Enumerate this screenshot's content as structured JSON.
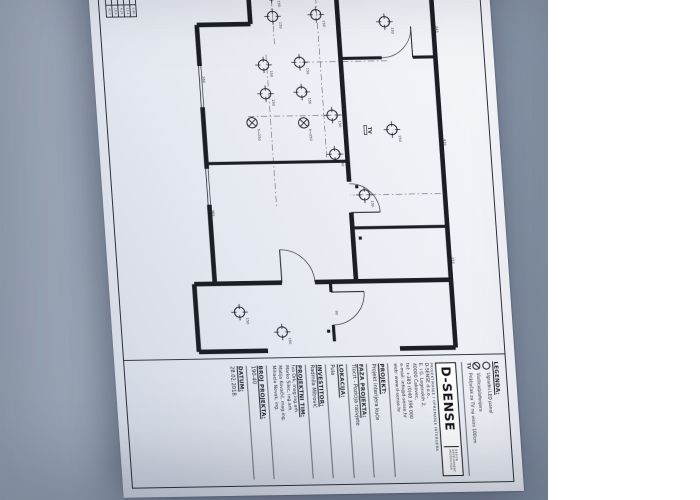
{
  "photo": {
    "backdrop_color": "#97a3b4",
    "paper_color": "#eef0f6"
  },
  "legend": {
    "title": "LEGENDA:",
    "items": [
      {
        "symbol": "led-circle",
        "label": "Ugradni LED panel"
      },
      {
        "symbol": "pendant-circle",
        "label": "Visilica/plafonjera"
      },
      {
        "symbol": "tv",
        "label": "Priključak za TV na visini 100cm"
      }
    ]
  },
  "logo": {
    "name": "D-SENSE",
    "side_words": [
      "DESIGN",
      "DEVELOPMENT",
      "PRODUCTION"
    ],
    "subtitle": "PROJEKTIRANJE I OPREMANJE INTERIJERA"
  },
  "company": {
    "lines": [
      "D-SENSE d.o.o.,",
      "E. i G. Legenskih 2,",
      "40000 Čakovec,",
      "tel: +385 (0)40 396 000",
      "e-mail: info@d-sense.hr",
      "web: www.d-sense.hr"
    ]
  },
  "titleblock": {
    "projekt": {
      "label": "PROJEKT:",
      "value": "Projekt interijera kuće"
    },
    "faza": {
      "label": "FAZA PROJEKTA:",
      "value": "Tlocrt - Pozicija rasvjete"
    },
    "lokacija": {
      "label": "LOKACIJA:",
      "value": "Pula"
    },
    "investitor": {
      "label": "INVESTITOR:",
      "value": "Radmila Mitrović"
    },
    "team": {
      "label": "PROJEKTNI TIM:",
      "members": [
        "Iva Ork, mag.ing.arh.",
        "Marko Šilec, ing.arh.",
        "Matija Kovačić, mag.ing.",
        "Mihaela Novak, ing."
      ]
    },
    "broj": {
      "label": "BROJ PROJEKTA:",
      "value": "190-40"
    },
    "datum": {
      "label": "DATUM:",
      "value": "28.02.2018."
    }
  },
  "rooms_table": {
    "rows": [
      [
        "1",
        "····· ····",
        "··",
        "9.80"
      ],
      [
        "2",
        "······ ··",
        "··",
        "12.4"
      ],
      [
        "3",
        "···· ···",
        "··",
        "6.25"
      ],
      [
        "4",
        "······· ·",
        "··",
        "18.6"
      ],
      [
        "5",
        "···· ····",
        "··",
        "41.2"
      ]
    ]
  },
  "plan": {
    "walls": [
      [
        2,
        8,
        368,
        8,
        4.5
      ],
      [
        2,
        8,
        2,
        100,
        3.5
      ],
      [
        368,
        8,
        368,
        62,
        4.5
      ],
      [
        85,
        8,
        85,
        30,
        3
      ],
      [
        85,
        60,
        85,
        100,
        3
      ],
      [
        250,
        8,
        250,
        100,
        3
      ],
      [
        0,
        100,
        205,
        100,
        4.5
      ],
      [
        235,
        100,
        302,
        100,
        4.5
      ],
      [
        185,
        100,
        185,
        237,
        3
      ],
      [
        2,
        185,
        50,
        185,
        4.5
      ],
      [
        50,
        185,
        50,
        237,
        4.5
      ],
      [
        50,
        237,
        90,
        237,
        4.5
      ],
      [
        130,
        237,
        190,
        237,
        4.5
      ],
      [
        225,
        237,
        302,
        237,
        4.5
      ],
      [
        302,
        8,
        302,
        140,
        4.5
      ],
      [
        302,
        172,
        302,
        257,
        4.5
      ],
      [
        302,
        125,
        312,
        125,
        3
      ],
      [
        344,
        125,
        360,
        125,
        3
      ],
      [
        302,
        257,
        368,
        257,
        4.5
      ],
      [
        368,
        190,
        368,
        257,
        4.5
      ]
    ],
    "windows": [
      [
        150,
        8,
        200,
        8
      ],
      [
        90,
        237,
        130,
        237
      ],
      [
        190,
        237,
        225,
        237
      ],
      [
        2,
        40,
        2,
        70
      ]
    ],
    "doors": [
      {
        "line": [
          85,
          30,
          55,
          30
        ],
        "arc": "M 55 30 A 30 30 0 0 1 85 60"
      },
      {
        "line": [
          312,
          125,
          312,
          93
        ],
        "arc": "M 312 93 A 32 32 0 0 1 344 125"
      },
      {
        "line": [
          302,
          172,
          270,
          172
        ],
        "arc": "M 270 172 A 32 32 0 0 1 302 140"
      },
      {
        "line": [
          235,
          100,
          235,
          72
        ],
        "arc": "M 235 72 A 28 28 0 0 0 207 100"
      }
    ],
    "axes": [
      [
        0,
        120,
        185,
        120
      ],
      [
        140,
        100,
        140,
        195
      ],
      [
        80,
        172,
        230,
        172
      ],
      [
        88,
        55,
        88,
        140
      ],
      [
        2,
        163,
        70,
        163
      ],
      [
        218,
        12,
        218,
        100
      ]
    ],
    "lights_led": [
      [
        22,
        163,
        "150"
      ],
      [
        43,
        163,
        "150"
      ],
      [
        14,
        122,
        "150"
      ],
      [
        42,
        121,
        "150"
      ],
      [
        50,
        55,
        "150"
      ],
      [
        88,
        140,
        "150"
      ],
      [
        117,
        140,
        "150"
      ],
      [
        90,
        175,
        "150"
      ],
      [
        118,
        175,
        "150"
      ],
      [
        140,
        112,
        "150"
      ],
      [
        178,
        112,
        "150"
      ],
      [
        218,
        86,
        "150"
      ],
      [
        350,
        175,
        "150"
      ],
      [
        330,
        215,
        "150"
      ],
      [
        155,
        55,
        "150"
      ]
    ],
    "lights_pendant": [
      [
        146,
        190,
        "h=250"
      ],
      [
        147,
        140,
        "h=250"
      ]
    ],
    "dims": [
      [
        55,
        4,
        "245"
      ],
      [
        165,
        4,
        "410"
      ],
      [
        280,
        4,
        "150"
      ],
      [
        330,
        120,
        "90"
      ],
      [
        230,
        233,
        "385"
      ],
      [
        100,
        233,
        "260"
      ],
      [
        8,
        150,
        "120"
      ]
    ],
    "dots": [
      [
        210,
        93
      ],
      [
        260,
        93
      ],
      [
        350,
        130
      ]
    ],
    "tv": {
      "x": 152,
      "y": 78,
      "label": "TV"
    }
  }
}
